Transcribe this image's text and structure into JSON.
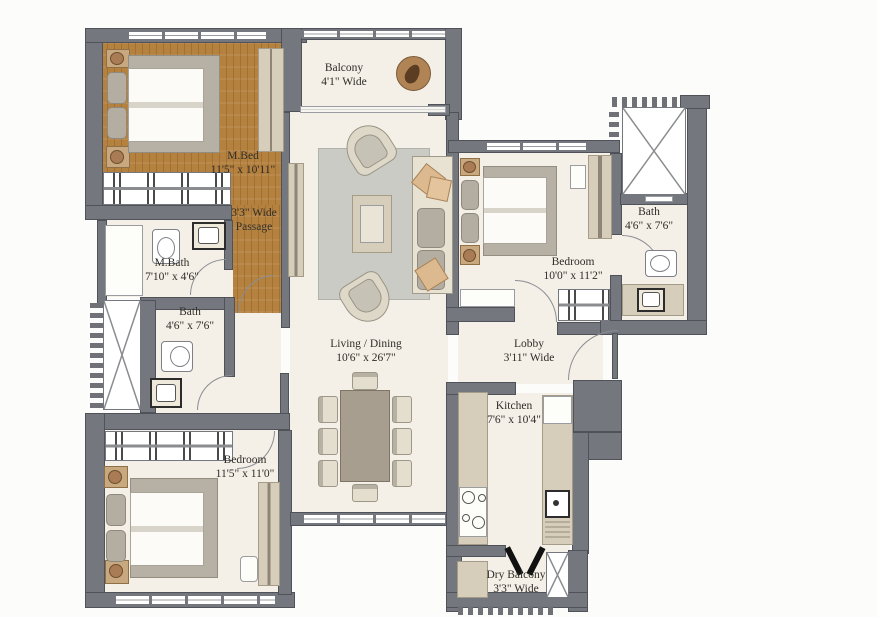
{
  "plan": {
    "rooms": {
      "balcony": {
        "line1": "Balcony",
        "line2": "4'1\" Wide"
      },
      "m_bed": {
        "line1": "M.Bed",
        "line2": "11'5\" x 10'11\""
      },
      "passage": {
        "line1": "3'3\" Wide",
        "line2": "Passage"
      },
      "m_bath": {
        "line1": "M.Bath",
        "line2": "7'10\" x 4'6\""
      },
      "bath_left": {
        "line1": "Bath",
        "line2": "4'6\" x 7'6\""
      },
      "bath_right": {
        "line1": "Bath",
        "line2": "4'6\" x 7'6\""
      },
      "bedroom_right": {
        "line1": "Bedroom",
        "line2": "10'0\" x 11'2\""
      },
      "bedroom_left": {
        "line1": "Bedroom",
        "line2": "11'5\" x 11'0\""
      },
      "living": {
        "line1": "Living / Dining",
        "line2": "10'6\" x 26'7\""
      },
      "lobby": {
        "line1": "Lobby",
        "line2": "3'11\" Wide"
      },
      "kitchen": {
        "line1": "Kitchen",
        "line2": "7'6\" x 10'4\""
      },
      "dry_balcony": {
        "line1": "Dry Balcony",
        "line2": "3'3\" Wide"
      }
    },
    "colors": {
      "wall": "#75777f",
      "wall_outline": "#50525a",
      "wood_floor": "#b5813f",
      "floor_cream": "#f4f0e7",
      "furniture_beige": "#d7cdbb",
      "rug_gray": "#cbcbc5",
      "text": "#2f2d29",
      "background": "#fcfcfb"
    }
  }
}
